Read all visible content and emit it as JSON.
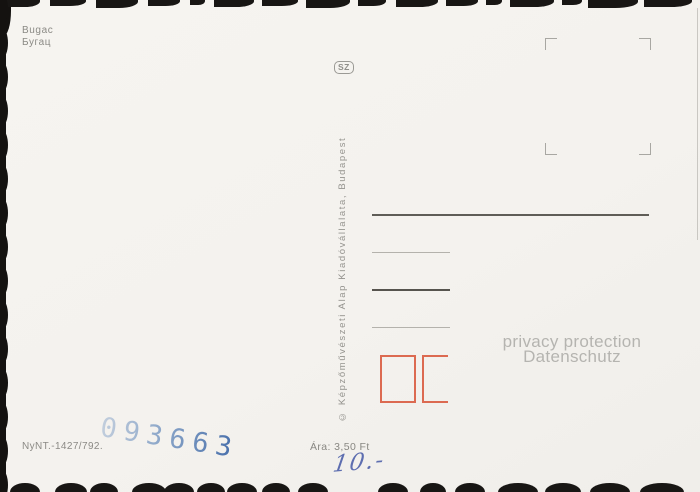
{
  "postcard": {
    "caption": "Bugac",
    "caption_cyrillic": "Бугац",
    "series_mark": "SZ",
    "copyright": "© Képzőművészeti Alap Kiadóvállalata, Budapest",
    "order_number": "NyNT.-1427/792.",
    "price": "Ára: 3,50 Ft",
    "control_stamp": "093663",
    "handwritten_price": "10.-"
  },
  "watermark": {
    "line1": "privacy protection",
    "line2": "Datenschutz"
  },
  "colors": {
    "paper": "#f4f2ee",
    "printed_ink_gray": "#8b8a85",
    "postal_box_red": "#dc6a51",
    "control_stamp_blue": "#5e85b8",
    "handwriting_blue": "#4a5da8",
    "watermark_gray": "#b5b4b0"
  }
}
